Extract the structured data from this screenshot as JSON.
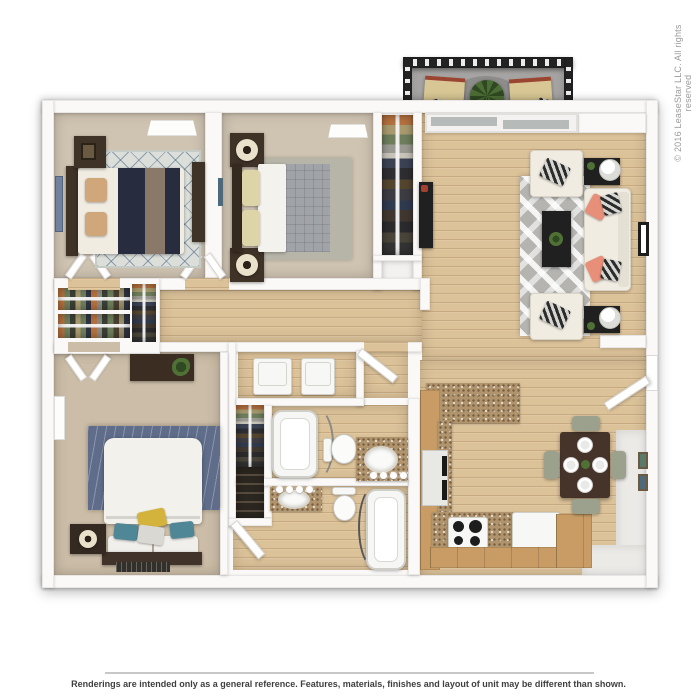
{
  "page": {
    "copyright": "© 2016 LeaseStar LLC. All rights reserved",
    "disclaimer": "Renderings are intended only as a general reference. Features, materials, finishes and layout of unit may be different than shown."
  },
  "palette": {
    "wall": "#faf9f7",
    "wood": "#dcc299",
    "carpet": "#cfc3b1",
    "carpet2": "#cbbda7",
    "closet": "#b2aca3",
    "granite": "#b0946e",
    "cabinet": "#c89c64",
    "navy": "#272d3f",
    "cream": "#f0ece2",
    "coral": "#e78f78",
    "rug_gray": "#b5b4b0",
    "rug_blue": "#5f6d8b",
    "quilt": "#a0a3a8",
    "dark_table": "#202020",
    "wood_table": "#46342a",
    "chair_sage": "#9ba18c",
    "plant": "#4f7136",
    "red_accent": "#a53f2f",
    "tan_pillow": "#cfa77b",
    "yellow_pillow": "#d4b33c",
    "teal_pillow": "#4f8796",
    "text_gray": "#9b9b9b",
    "text_dark": "#3f3f3f",
    "line_gray": "#c8c8c8"
  }
}
